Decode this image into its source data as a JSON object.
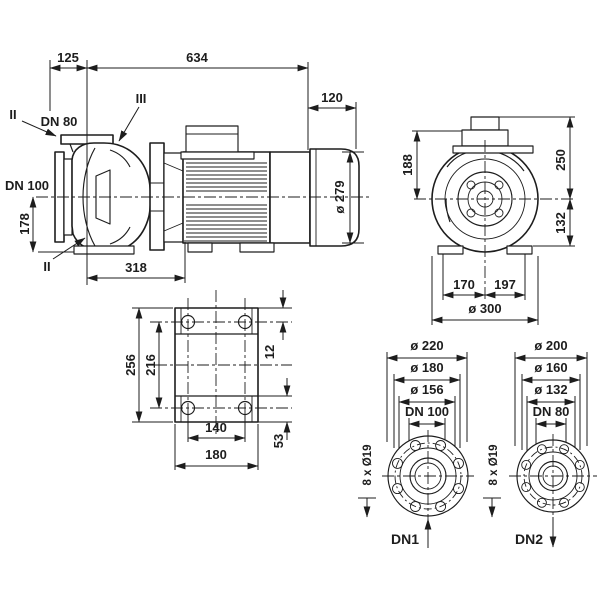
{
  "title": "Pump dimensional drawing",
  "colors": {
    "line": "#1d1d1d",
    "background": "#ffffff"
  },
  "side_view": {
    "dim_125": "125",
    "dim_634": "634",
    "dim_120": "120",
    "dim_dia_279": "ø 279",
    "dim_318": "318",
    "dim_178": "178",
    "label_dn80": "DN 80",
    "label_dn100": "DN 100",
    "marker_top": "II",
    "marker_mid": "III",
    "marker_bottom": "II"
  },
  "front_view": {
    "dim_188": "188",
    "dim_250": "250",
    "dim_132": "132",
    "dim_170": "170",
    "dim_197": "197",
    "dim_dia_300": "ø 300"
  },
  "base_view": {
    "dim_256": "256",
    "dim_216": "216",
    "dim_12": "12",
    "dim_140": "140",
    "dim_180": "180",
    "dim_53": "53"
  },
  "flange_dn1": {
    "dim_dia_220": "ø 220",
    "dim_dia_180": "ø 180",
    "dim_dia_156": "ø 156",
    "label_dn": "DN 100",
    "label_holes": "8 x Ø19",
    "port": "DN1"
  },
  "flange_dn2": {
    "dim_dia_200": "ø 200",
    "dim_dia_160": "ø 160",
    "dim_dia_132": "ø 132",
    "label_dn": "DN 80",
    "label_holes": "8 x Ø19",
    "port": "DN2"
  }
}
